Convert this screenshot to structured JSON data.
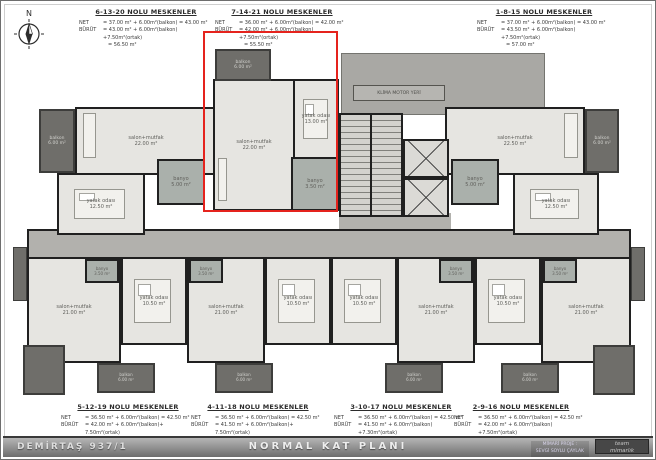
{
  "page": {
    "compass_label": "N"
  },
  "colors": {
    "highlight": "#e5231d",
    "wall": "#202020",
    "balcony": "#6f6e6a"
  },
  "top_specs": [
    {
      "title": "6-13-20 NOLU MESKENLER",
      "net_label": "NET",
      "net": "= 37.00 m² + 6.00m²(balkon) = 43.00 m²",
      "brut_label": "BÜRÜT",
      "brut": "= 43.00 m² + 6.00m²(balkon) +7.50m²(ortak)",
      "total": "= 56.50 m²"
    },
    {
      "title": "7-14-21 NOLU MESKENLER",
      "net_label": "NET",
      "net": "= 36.00 m² + 6.00m²(balkon) = 42.00 m²",
      "brut_label": "BÜRÜT",
      "brut": "= 42.00 m² + 6.00m²(balkon) +7.50m²(ortak)",
      "total": "= 55.50 m²"
    },
    {
      "title": "1-8-15  NOLU MESKENLER",
      "net_label": "NET",
      "net": "= 37.00 m² + 6.00m²(balkon) = 43.00 m²",
      "brut_label": "BÜRÜT",
      "brut": "= 43.50 m² + 6.00m²(balkon) +7.50m²(ortak)",
      "total": "= 57.00 m²"
    }
  ],
  "bottom_specs": [
    {
      "title": "5-12-19 NOLU MESKENLER",
      "net_label": "NET",
      "net": "= 36.50 m² + 6.00m²(balkon) = 42.50 m²",
      "brut_label": "BÜRÜT",
      "brut": "= 42.00 m² + 6.00m²(balkon)+ 7.50m²(ortak)",
      "total": "= 55.50 m²"
    },
    {
      "title": "4-11-18 NOLU MESKENLER",
      "net_label": "NET",
      "net": "= 36.50 m² + 6.00m²(balkon) = 42.50 m²",
      "brut_label": "BÜRÜT",
      "brut": "= 41.50 m² + 6.00m²(balkon)+ 7.50m²(ortak)",
      "total": "= 55.00 m²"
    },
    {
      "title": "3-10-17 NOLU MESKENLER",
      "net_label": "NET",
      "net": "= 36.50 m² + 6.00m²(balkon) = 42.50 m²",
      "brut_label": "BÜRÜT",
      "brut": "= 41.50 m² + 6.00m²(balkon) +7.30m²(ortak)",
      "total": "= 55.00 m²"
    },
    {
      "title": "2-9-16  NOLU MESKENLER",
      "net_label": "NET",
      "net": "= 36.50 m² + 6.00m²(balkon) = 42.50 m²",
      "brut_label": "BÜRÜT",
      "brut": "= 42.00 m² + 6.00m²(balkon) +7.50m²(ortak)",
      "total": "= 55.50 m²"
    }
  ],
  "plan": {
    "klima_label": "KLİMA MOTOR YERİ",
    "units": {
      "a": {
        "salon_name": "salon+mutfak",
        "salon_area": "22.00 m²",
        "bed_name": "yatak odası",
        "bed_area": "12.50 m²",
        "bath_name": "banyo",
        "bath_area": "5.00 m²",
        "balcony_name": "balkon",
        "balcony_area": "6.00 m²"
      },
      "b": {
        "salon_name": "salon+mutfak",
        "salon_area": "22.00 m²",
        "bed_name": "yatak odası",
        "bed_area": "13.00 m²",
        "bath_name": "banyo",
        "bath_area": "3.50 m²",
        "balcony_name": "balkon",
        "balcony_area": "6.00 m²"
      },
      "c": {
        "salon_name": "salon+mutfak",
        "salon_area": "22.50 m²",
        "bed_name": "yatak odası",
        "bed_area": "12.50 m²",
        "bath_name": "banyo",
        "bath_area": "5.00 m²",
        "balcony_name": "balkon",
        "balcony_area": "6.00 m²"
      },
      "b1": {
        "salon_name": "salon+mutfak",
        "salon_area": "21.00 m²",
        "bed_name": "yatak odası",
        "bed_area": "10.50 m²",
        "bath_name": "banyo",
        "bath_area": "3.50 m²",
        "balcony_name": "balkon",
        "balcony_area": "6.00 m²"
      },
      "b2": {
        "salon_name": "salon+mutfak",
        "salon_area": "21.00 m²",
        "bed_name": "yatak odası",
        "bed_area": "10.50 m²",
        "bath_name": "banyo",
        "bath_area": "3.50 m²",
        "balcony_name": "balkon",
        "balcony_area": "6.00 m²"
      },
      "b3": {
        "salon_name": "salon+mutfak",
        "salon_area": "21.00 m²",
        "bed_name": "yatak odası",
        "bed_area": "10.50 m²",
        "bath_name": "banyo",
        "bath_area": "3.50 m²",
        "balcony_name": "balkon",
        "balcony_area": "6.00 m²"
      },
      "b4": {
        "salon_name": "salon+mutfak",
        "salon_area": "21.00 m²",
        "bed_name": "yatak odası",
        "bed_area": "10.50 m²",
        "bath_name": "banyo",
        "bath_area": "3.50 m²",
        "balcony_name": "balkon",
        "balcony_area": "6.00 m²"
      }
    }
  },
  "footer": {
    "project": "DEMİRTAŞ 937/1",
    "title": "NORMAL KAT PLANI",
    "credit_label": "MİMARİ PROJE :",
    "credit_name": "SEVGİ SOYLU ÇAYLAK",
    "logo_line1": "team",
    "logo_line2": "mimarlık"
  }
}
